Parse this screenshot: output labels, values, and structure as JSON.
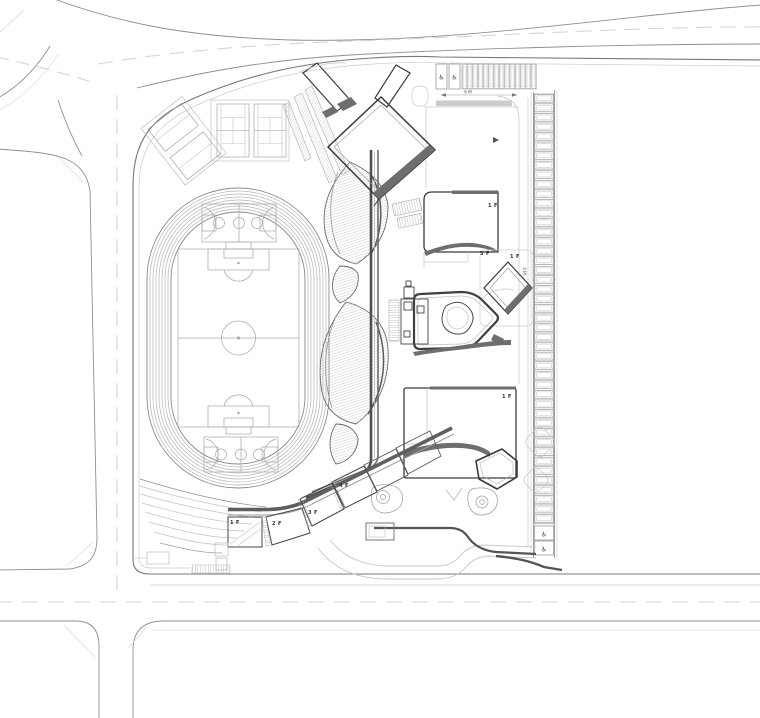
{
  "plan": {
    "kind": "architectural-site-plan",
    "floor_labels": [
      {
        "id": "sw-wing-block-1",
        "text": "1 F"
      },
      {
        "id": "sw-wing-block-2",
        "text": "2 F"
      },
      {
        "id": "sw-wing-block-3",
        "text": "3 F"
      },
      {
        "id": "sw-wing-block-4",
        "text": "4 F"
      },
      {
        "id": "ne-building",
        "text": "1 F"
      },
      {
        "id": "center-tower",
        "text": "5 F"
      },
      {
        "id": "center-east",
        "text": "1 F"
      },
      {
        "id": "se-building",
        "text": "1 F"
      }
    ],
    "dimensions": [
      {
        "id": "north-parking",
        "text": "6 M"
      },
      {
        "id": "east-parking",
        "text": "4 M"
      }
    ],
    "icons": {
      "accessible_parking": "♿"
    },
    "colors": {
      "background": "#ffffff",
      "building_outline": "#3a3a3a",
      "roof_band": "#6e6e6e",
      "spine": "#4f4f4f",
      "road_edge": "#8f8f8f",
      "site_boundary": "#777777",
      "light_line": "#c6c6c6",
      "sport_line": "#a8a8a8",
      "dash_line": "#d4d4d4",
      "label": "#2e2e2e"
    }
  }
}
